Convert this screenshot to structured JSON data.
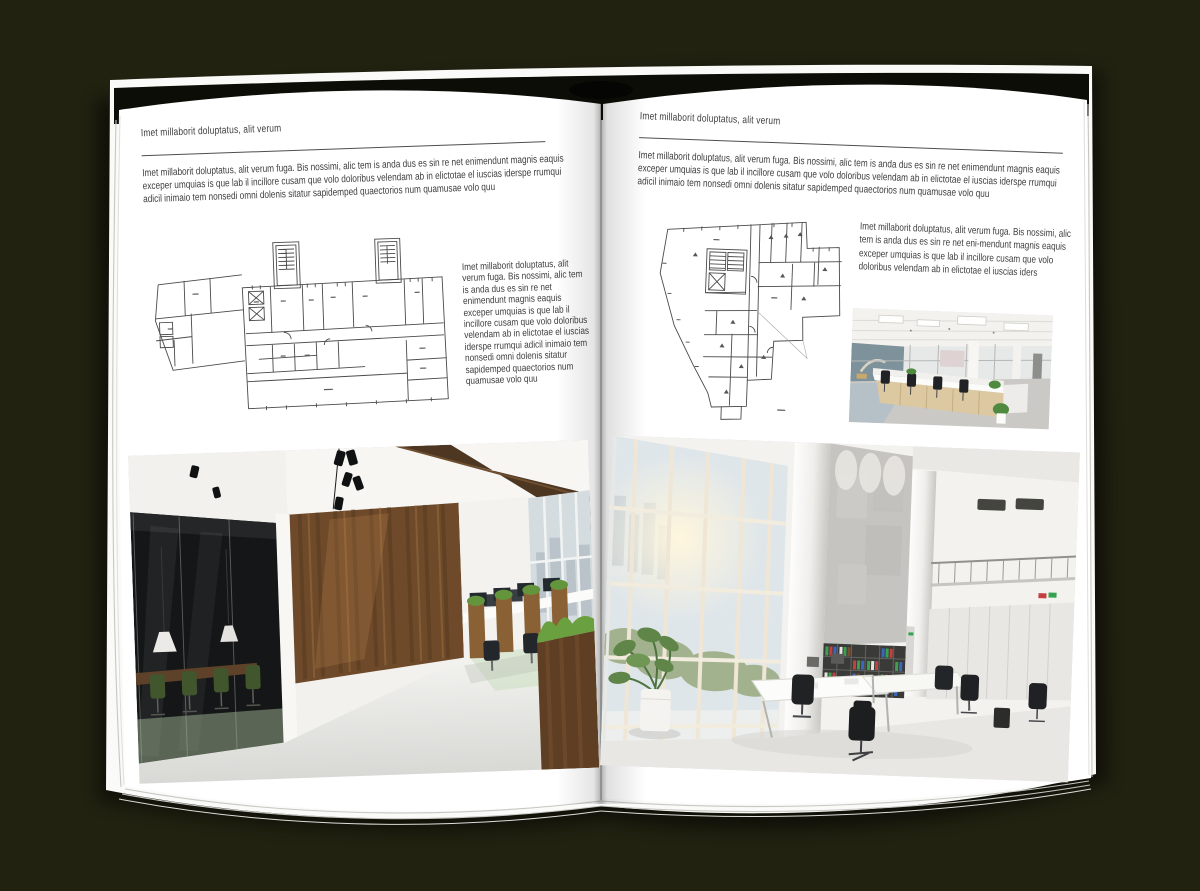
{
  "colors": {
    "background": "#222211",
    "page": "#ffffff",
    "text": "#3d3d3d",
    "rule": "#4e4e4e",
    "plan_line": "#4a4a4a",
    "wood_accent": "#6e4a2a",
    "plant_green": "#5f8c39"
  },
  "left_page": {
    "header": "Imet millaborit doluptatus, alit verum",
    "intro": "Imet millaborit doluptatus, alit verum fuga. Bis nossimi, alic tem is anda dus es sin re net enimendunt magnis eaquis exceper umquias is que lab il incillore cusam que volo doloribus velendam ab in elictotae el iuscias iderspe rrumqui adicil inimaio tem nonsedi omni dolenis sitatur sapidemped quaectorios num quamusae volo quu",
    "side_text": "Imet millaborit doluptatus, alit verum fuga. Bis nossimi, alic tem is anda dus es sin re net enimendunt magnis eaquis exceper umquias is que lab il incillore cusam que volo doloribus velendam ab in elictotae el iuscias iderspe rrumqui adicil inimaio tem nonsedi omni dolenis sitatur sapidemped quaectorios num quamusae volo quu",
    "figures": {
      "floor_plan": "scanned-building-floor-plan",
      "photo": "dark-wood-and-glass-office-interior"
    }
  },
  "right_page": {
    "header": "Imet millaborit doluptatus, alit verum",
    "intro": "Imet millaborit doluptatus, alit verum fuga. Bis nossimi, alic tem is anda dus es sin re net enimendunt magnis eaquis exceper umquias is que lab il incillore cusam que volo doloribus velendam ab in elictotae el iuscias iderspe rrumqui adicil inimaio tem nonsedi omni dolenis sitatur sapidemped quaectorios num quamusae volo quu",
    "caption": "Imet millaborit doluptatus, alit verum fuga. Bis nossimi, alic tem is anda dus es sin re net eni-mendunt magnis eaquis exceper umquias is que lab il incillore cusam que volo doloribus velendam ab in elictotae el iuscias iders",
    "figures": {
      "floor_plan": "scanned-irregular-floor-plan",
      "photo_small": "open-plan-office-interior",
      "photo_large": "bright-two-storey-office-atrium"
    }
  }
}
